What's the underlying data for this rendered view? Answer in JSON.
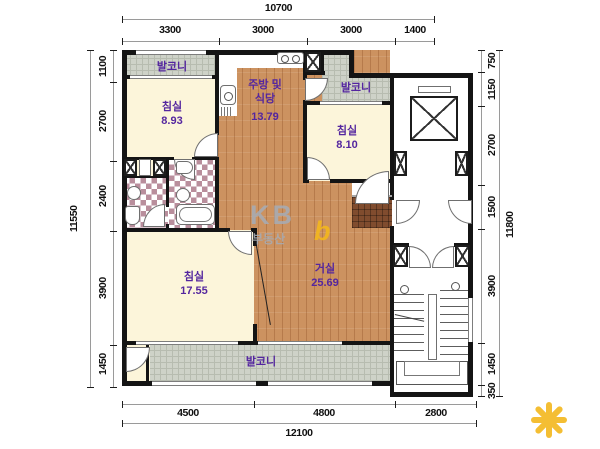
{
  "watermark": {
    "brand": "KB",
    "subtext": "부동산",
    "logo_letter": "b"
  },
  "rooms": {
    "balcony_top_left": {
      "name": "발코니"
    },
    "bedroom_top_left": {
      "name": "침실",
      "area": "8.93"
    },
    "kitchen": {
      "name_line1": "주방 및",
      "name_line2": "식당",
      "area": "13.79"
    },
    "balcony_top_right": {
      "name": "발코니"
    },
    "bedroom_right": {
      "name": "침실",
      "area": "8.10"
    },
    "bedroom_main": {
      "name": "침실",
      "area": "17.55"
    },
    "living_room": {
      "name": "거실",
      "area": "25.69"
    },
    "balcony_bottom": {
      "name": "발코니"
    }
  },
  "dimensions": {
    "top": {
      "total": "10700",
      "segments": [
        "3300",
        "3000",
        "3000",
        "1400"
      ]
    },
    "left": {
      "total": "11550",
      "segments": [
        "1100",
        "2700",
        "2400",
        "3900",
        "1450"
      ]
    },
    "right": {
      "total": "11800",
      "segments": [
        "750",
        "1150",
        "2700",
        "1500",
        "3900",
        "1450",
        "350"
      ]
    },
    "bottom": {
      "total": "12100",
      "segments": [
        "4500",
        "4800",
        "2800"
      ]
    }
  },
  "colors": {
    "label": "#54269f",
    "wood": "#cc9260",
    "cream": "#fcf5da",
    "balcony_tile": "#ced2c8",
    "bath_tile": "#b98e9c",
    "entry_tile": "#804c2e",
    "wall": "#141414",
    "kb_yellow": "#f3b71c",
    "kb_grey": "#a7abb2"
  }
}
